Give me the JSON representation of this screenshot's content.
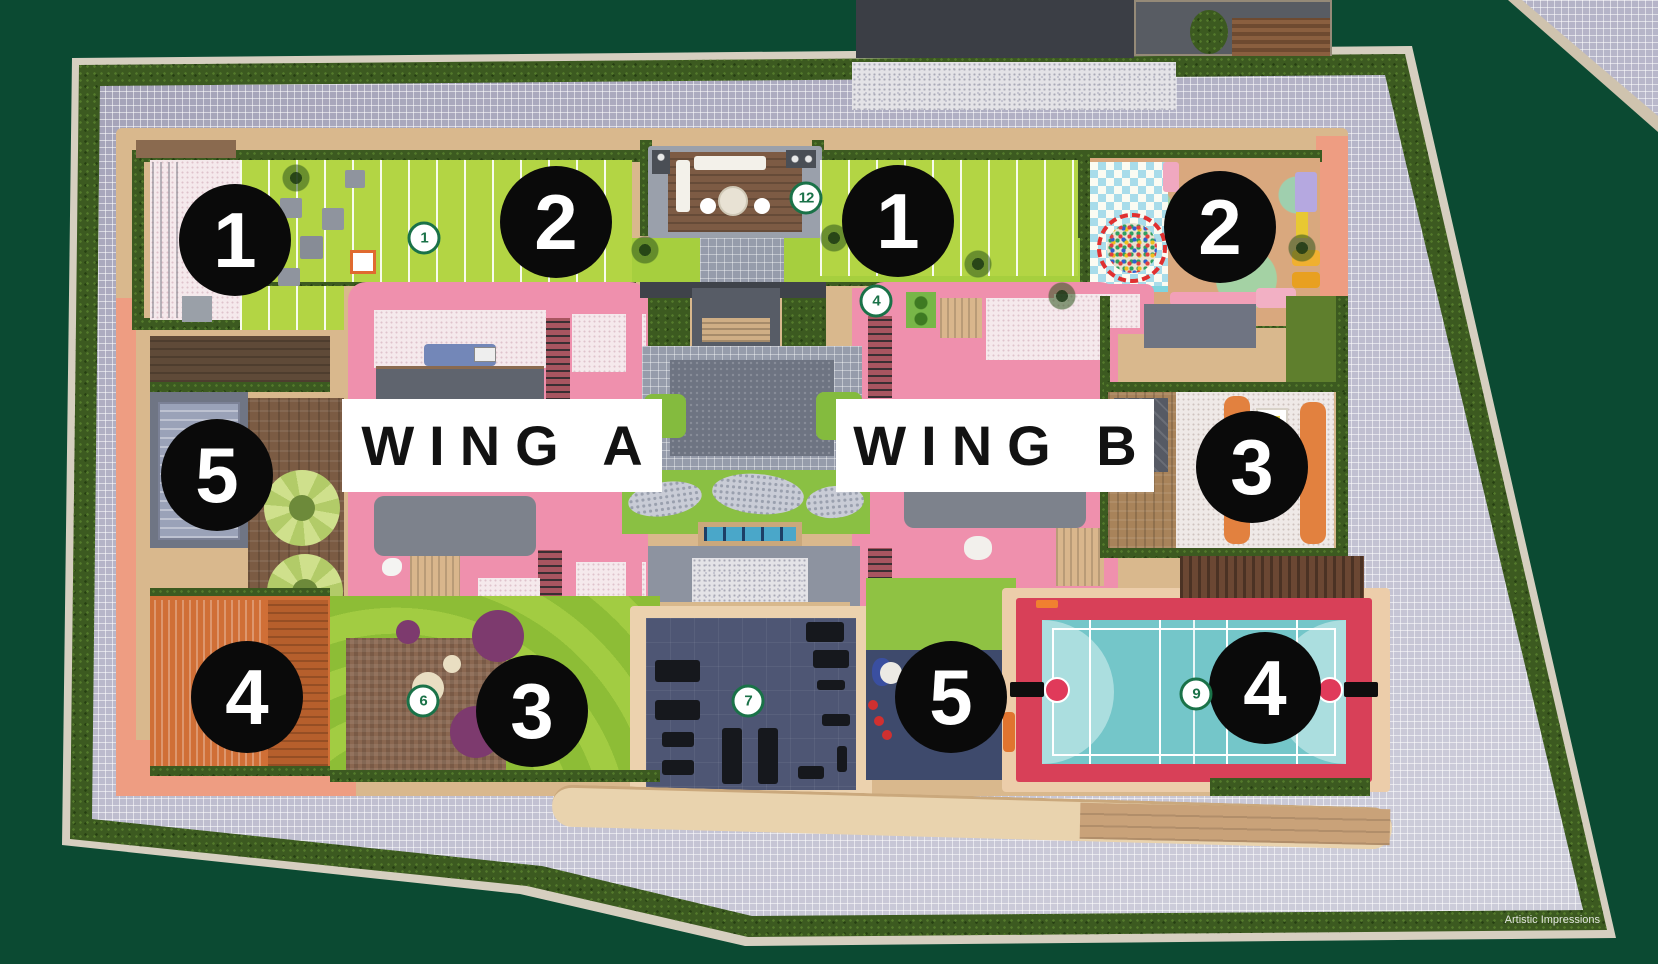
{
  "scene": {
    "credit": "Artistic Impressions",
    "background_color": "#0B4A32"
  },
  "wings": [
    {
      "label": "WING A"
    },
    {
      "label": "WING B"
    }
  ],
  "amenity_markers": [
    {
      "number": "1"
    },
    {
      "number": "2"
    },
    {
      "number": "1"
    },
    {
      "number": "2"
    },
    {
      "number": "5"
    },
    {
      "number": "3"
    },
    {
      "number": "4"
    },
    {
      "number": "3"
    },
    {
      "number": "5"
    },
    {
      "number": "4"
    }
  ],
  "point_markers": [
    {
      "number": "1"
    },
    {
      "number": "12"
    },
    {
      "number": "4"
    },
    {
      "number": "6"
    },
    {
      "number": "7"
    },
    {
      "number": "9"
    }
  ],
  "colors": {
    "background": "#0B4A32",
    "amenity_marker_bg": "#0A0A0A",
    "amenity_marker_text": "#FFFFFF",
    "point_marker_ring": "#1A7248",
    "wing_label_bg": "#FFFFFF",
    "wing_label_text": "#121212",
    "building_pink": "#EF90AD",
    "court_red": "#D84058",
    "court_teal": "#74C6C9",
    "lawn_green": "#B3D544",
    "hedge_green": "#3C5A20",
    "paver_grey": "#B9B8CB",
    "gym_floor_navy": "#4E5674",
    "deck_orange": "#D06F36"
  }
}
